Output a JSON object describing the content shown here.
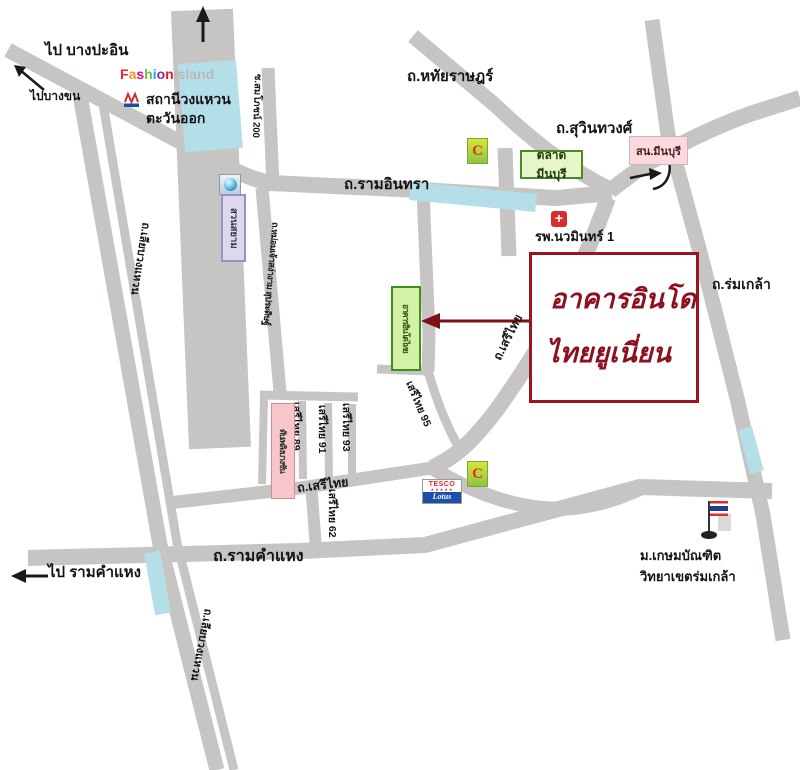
{
  "directions": {
    "to_bang_pa_in": "ไป บางปะอิน",
    "to_bang_khen": "ไปบางขน",
    "to_ram_khamhaeng": "ไป รามคำแหง"
  },
  "roads": {
    "ramindra": "ถ.รามอินทรา",
    "hathairat": "ถ.หทัยราษฎร์",
    "suwinthawong": "ถ.สุวินทวงศ์",
    "romklao": "ถ.ร่มเกล้า",
    "serithai_curve": "ถ.เสรีไทย",
    "serithai_bottom": "ถ.เสรีไทย",
    "ram_khamhaeng": "ถ.รามคำแหง",
    "liap_wongwaen_upper": "ถ.เลียบวงแหวน",
    "liap_wongwaen_lower": "ถ.เลียบวงแหวน",
    "soi_somphot_200": "ซ.สมโภชน์ 200",
    "mom_chao": "ถ.หม่อมเจ้าสง่างาม สุประดิษฐ์",
    "soi_89": "เสรีไทย 89",
    "soi_91": "เสรีไทย 91",
    "soi_93": "เสรีไทย 93",
    "soi_95": "เสรีไทย 95",
    "soi_62": "เสรีไทย 62"
  },
  "places": {
    "destination_line1": "อาคารอินโด",
    "destination_line2": "ไทยยูเนี่ยน",
    "indo_thai_building": "อาคารอินโดไทย",
    "suan_siam": "สวนสยาม",
    "ring_road_station_line1": "สถานีวงแหวน",
    "ring_road_station_line2": "ตะวันออก",
    "talat_minburi": "ตลาดมีนบุรี",
    "minburi_police": "สน.มีนบุรี",
    "nawamin_hospital": "รพ.นวมินทร์ 1",
    "bang_chan_fire_station": "ดับเพลิงบางชัน",
    "university_line1": "ม.เกษมบัณฑิต",
    "university_line2": "วิทยาเขตร่มเกล้า"
  },
  "logos": {
    "fashion_letters": [
      [
        "F",
        "#e8262d"
      ],
      [
        "a",
        "#f7941d"
      ],
      [
        "s",
        "#ec008c"
      ],
      [
        "h",
        "#72bf44"
      ],
      [
        "i",
        "#00aeef"
      ],
      [
        "o",
        "#92278f"
      ],
      [
        "n",
        "#ed1c24"
      ]
    ],
    "island": "island",
    "tesco": "TESCO",
    "tesco_stars": "★★★★★",
    "lotus": "Lotus",
    "big_c": "C",
    "hospital_cross": "+"
  },
  "colors": {
    "road": "#c6c5c3",
    "water": "#b5dfe8",
    "destination_red": "#8d1020",
    "arrow_red": "#7d0f18",
    "building_green_bg": "#d3f2a5",
    "building_green_border": "#3f8f1f",
    "market_green_bg": "#e7f6c9",
    "police_pink_bg": "#fadade",
    "fire_pink_bg": "#f6c6cb",
    "suan_siam_purple_bg": "#ded7f0"
  }
}
